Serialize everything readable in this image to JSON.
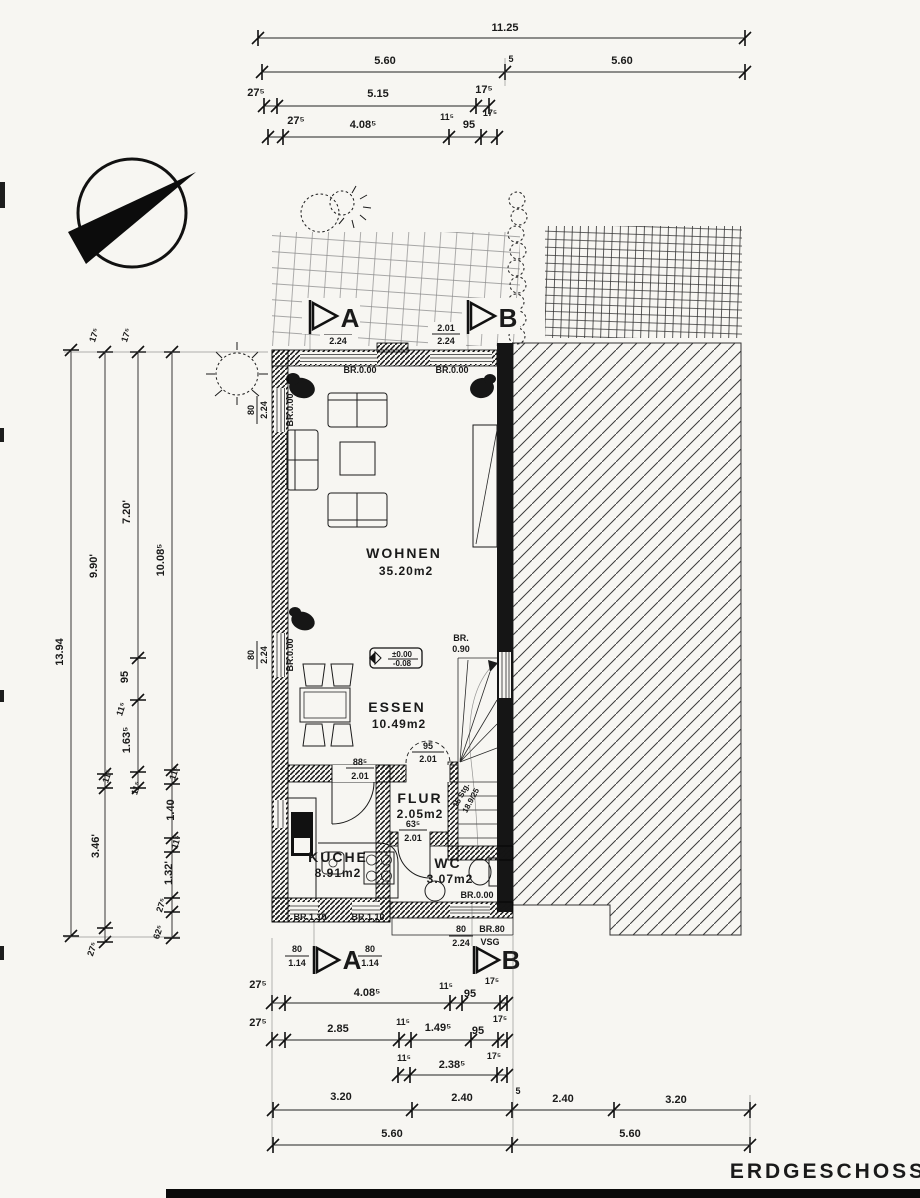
{
  "title": "ERDGESCHOSS",
  "markers": {
    "a": "A",
    "b": "B"
  },
  "rooms": {
    "wohnen": {
      "name": "WOHNEN",
      "area": "35.20m2"
    },
    "essen": {
      "name": "ESSEN",
      "area": "10.49m2"
    },
    "kueche": {
      "name": "KUCHE",
      "area": "8.91m2"
    },
    "flur": {
      "name": "FLUR",
      "area": "2.05m2"
    },
    "wc": {
      "name": "WC",
      "area": "3.07m2"
    }
  },
  "levels": {
    "upper": "±0.00",
    "lower": "-0.08"
  },
  "stair": {
    "line1": "15 Stg.",
    "line2": "18.9/25"
  },
  "ann": {
    "br000": "BR.0.00",
    "br110": "BR.1.10",
    "br090a": "BR.",
    "br090b": "0.90",
    "win_top_w": "2.01",
    "win_top_h": "2.24",
    "side_w": "80",
    "side_h": "2.24",
    "kwin_w": "80",
    "kwin_h": "1.14",
    "entry_w": "80",
    "entry_h": "2.24",
    "entry_br": "BR.80",
    "entry_glass": "VSG",
    "door_kueche_w": "88⁵",
    "door_flur_w": "95",
    "door_wc_w": "63⁵",
    "door_h": "2.01"
  },
  "dims": {
    "top": {
      "r1": [
        "11.25"
      ],
      "r2": [
        "5.60",
        "5",
        "5.60"
      ],
      "r3": [
        "27⁵",
        "5.15",
        "17⁵"
      ],
      "r4": [
        "27⁵",
        "4.08⁵",
        "11⁵",
        "95",
        "17⁵"
      ]
    },
    "left": {
      "c1": [
        "13.94"
      ],
      "c2": [
        "17⁵",
        "9.90'",
        "11⁵",
        "3.46'",
        "27⁵"
      ],
      "c3": [
        "17⁵",
        "7.20'",
        "95",
        "11⁵",
        "1.63⁵",
        "11⁵"
      ],
      "c4": [
        "10.08⁵",
        "11⁵",
        "1.40",
        "11⁵",
        "1.32'",
        "27⁵",
        "62⁵"
      ]
    },
    "bottom": {
      "r1": [
        "27⁵",
        "4.08⁵",
        "11⁵",
        "95",
        "17⁵"
      ],
      "r2": [
        "27⁵",
        "2.85",
        "11⁵",
        "1.49⁵",
        "95",
        "17⁵"
      ],
      "r3": [
        "11⁵",
        "2.38⁵",
        "17⁵"
      ],
      "r4": [
        "3.20",
        "2.40",
        "5",
        "2.40",
        "3.20"
      ],
      "r5": [
        "5.60",
        "5.60"
      ]
    }
  }
}
